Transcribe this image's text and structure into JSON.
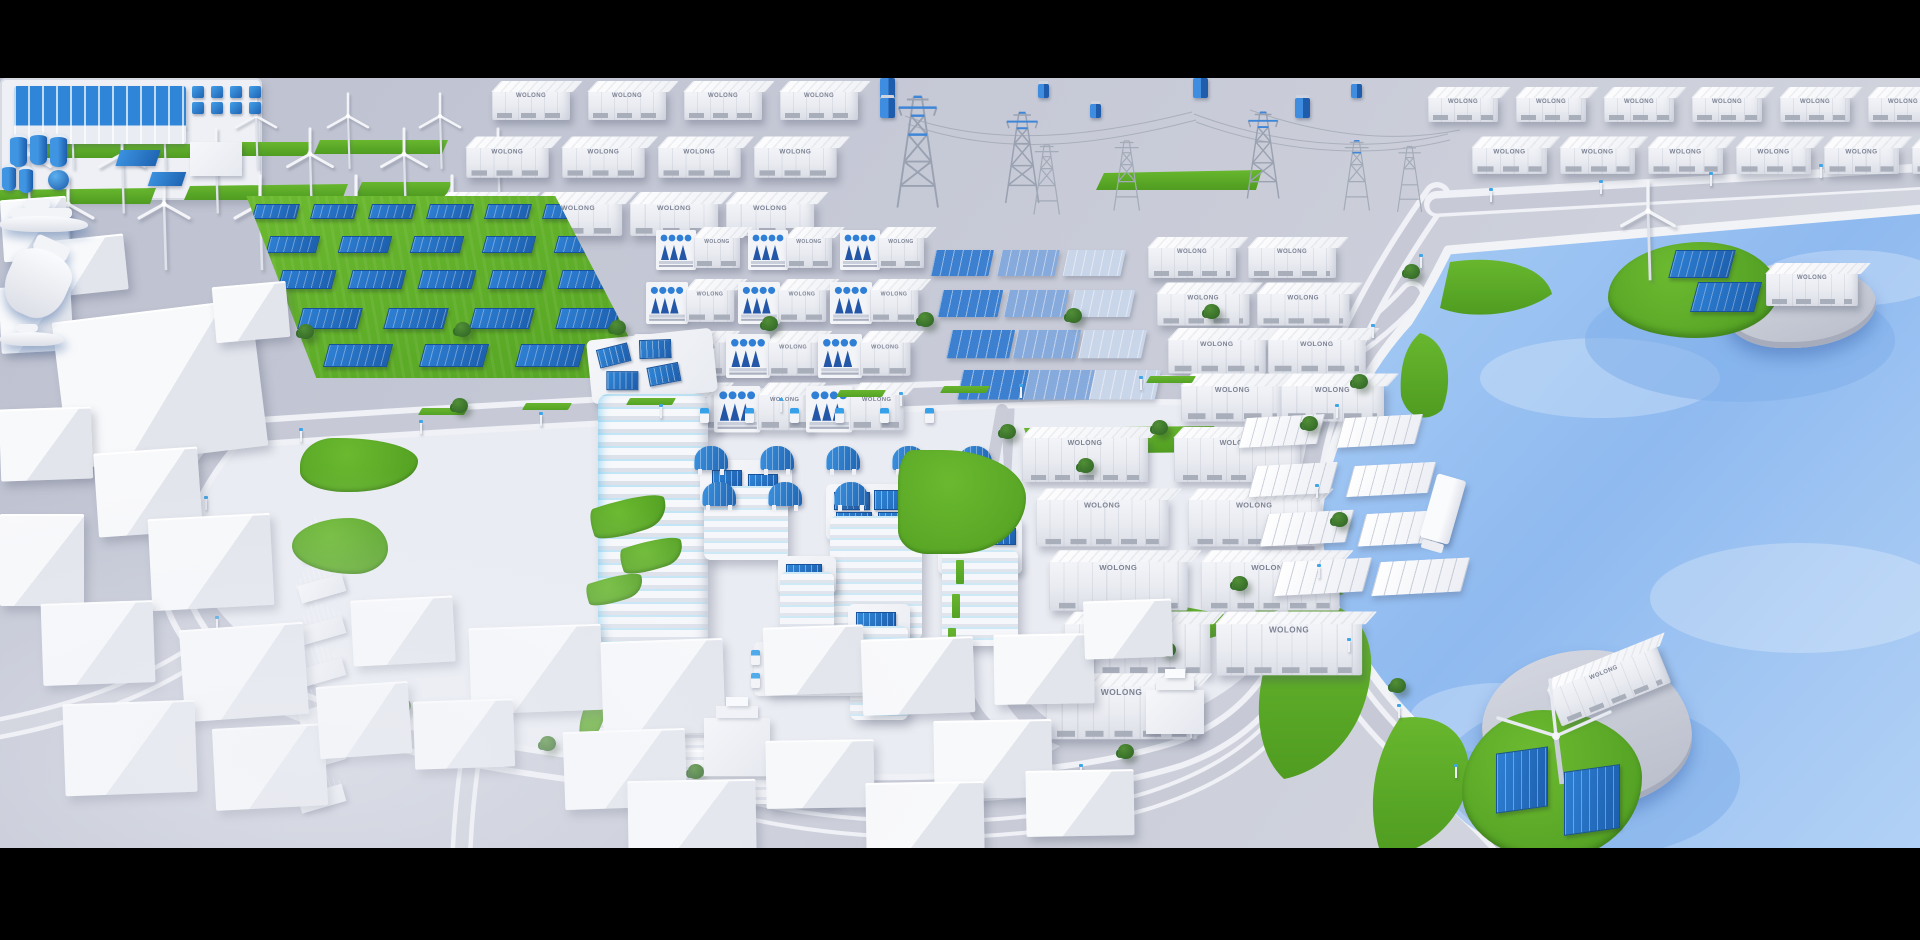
{
  "scene": {
    "description": "Isometric 3D render of a coastal smart-energy city: wind farm, battery-storage container yards, solar farms, grid substation with pylons, a green campus with solar-roof tower and houses, EV chargers, white low-poly city blocks, and a harbor with energy islands and boats",
    "colors": {
      "letterbox": "#000000",
      "ground": "#c6c9d6",
      "road": "#c7cad6",
      "sidewalk": "#eff1f6",
      "plaza": "#eaecf3",
      "grass": "#5aab28",
      "water": "#9dc3f1",
      "panel_blue": "#2a78cc",
      "accent_cyan": "#3ab5e9",
      "structure_white": "#f2f3f7"
    }
  },
  "labels": {
    "container_nameplate": "WOLONG"
  },
  "inventory": {
    "wind_row1": 5,
    "wind_row2": 6,
    "wind_row3": 5,
    "yard_nw_containers": 12,
    "yard_ne_containers": 12,
    "yard_mid_containers": 8,
    "yard_se_containers": 9,
    "white_canopies": 8,
    "battery_stacks": 12,
    "gradient_panels": 12,
    "solar_row1": 6,
    "solar_row2": 5,
    "solar_row3": 6,
    "solar_row4": 5,
    "solar_row5": 4,
    "carport_row1": 5,
    "carport_row2": 5,
    "ev_chargers_row": 6,
    "ev_charger_pad": 8,
    "houses": 7,
    "pylons": 7,
    "transformer_banks": 2,
    "islands": 2,
    "boats": 3,
    "trucks": 1
  }
}
